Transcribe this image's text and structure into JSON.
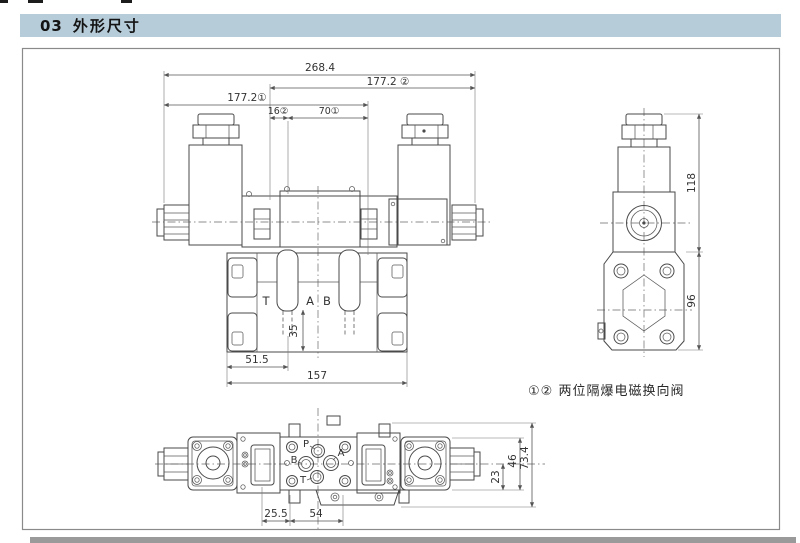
{
  "colors": {
    "header_bg": "#b6ccd9",
    "line": "#4a4a4a",
    "page_bg": "#ffffff"
  },
  "header": {
    "number": "03",
    "title": "外形尺寸"
  },
  "front_view": {
    "dim_total_width": "268.4",
    "dim_width_2": "177.2 ②",
    "dim_width_1": "177.2①",
    "dim_16": "16②",
    "dim_70": "70①",
    "label_port_t": "T",
    "label_port_a": "A",
    "label_port_b": "B",
    "dim_35": "35",
    "dim_51_5": "51.5",
    "dim_157": "157"
  },
  "side_view": {
    "dim_118": "118",
    "dim_96": "96"
  },
  "caption": {
    "text": "①② 两位隔爆电磁换向阀"
  },
  "bottom_view": {
    "label_port_p": "P",
    "label_port_a": "A",
    "label_port_b": "B",
    "label_port_t": "T",
    "dim_25_5": "25.5",
    "dim_54": "54",
    "dim_23": "23",
    "dim_46": "46",
    "dim_73_4": "73.4"
  }
}
